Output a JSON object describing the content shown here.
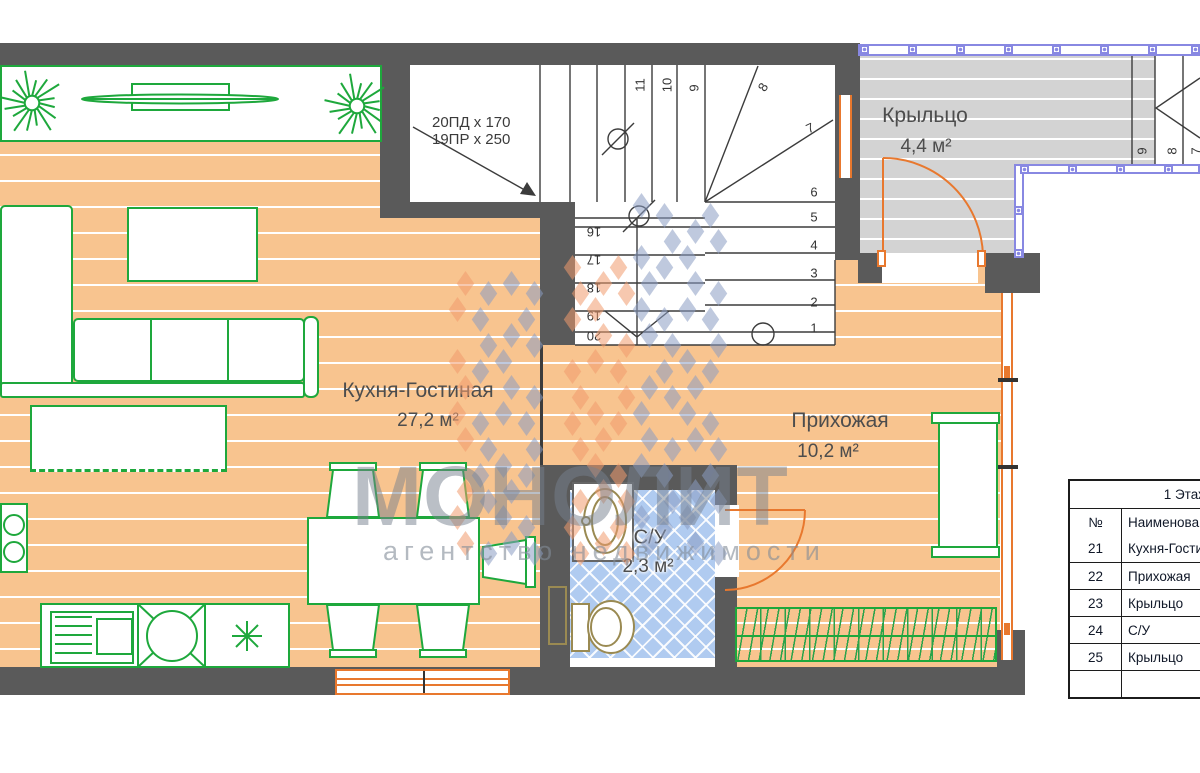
{
  "rooms": [
    {
      "name": "Кухня-Гостиная",
      "area": "27,2 м²"
    },
    {
      "name": "Прихожая",
      "area": "10,2 м²"
    },
    {
      "name": "Крыльцо",
      "area": "4,4 м²"
    },
    {
      "name": "С/У",
      "area": "2,3 м²"
    }
  ],
  "stairs": {
    "spec_line1": "20ПД x 170",
    "spec_line2": "19ПР x 250",
    "upper_steps": [
      "11",
      "10",
      "9",
      "8",
      "7"
    ],
    "right_steps": [
      "6",
      "5",
      "4",
      "3",
      "2",
      "1"
    ],
    "lower_steps": [
      "16",
      "17",
      "18",
      "19",
      "20"
    ],
    "exterior_steps": [
      "9",
      "8",
      "7"
    ]
  },
  "legend_table": {
    "title": "1 Этаж",
    "columns": [
      "№",
      "Наименование"
    ],
    "rows": [
      [
        "21",
        "Кухня-Гостиная"
      ],
      [
        "22",
        "Прихожая"
      ],
      [
        "23",
        "Крыльцо"
      ],
      [
        "24",
        "С/У"
      ],
      [
        "25",
        "Крыльцо"
      ],
      [
        "",
        ""
      ]
    ]
  },
  "watermark": {
    "name": "МОНОЛИТ",
    "subtitle": "агентство недвижимости"
  },
  "colors": {
    "wall": "#5a5a5a",
    "floor_orange": "#f8c48f",
    "porch_gray": "#d3d3d3",
    "tile_blue": "#b0cbf0",
    "furniture_green": "#1ea83c",
    "joinery_orange": "#e8782e",
    "railing_blue": "#8888e2",
    "logo_blue": "#8a9cc2",
    "logo_orange": "#f09a6e"
  }
}
